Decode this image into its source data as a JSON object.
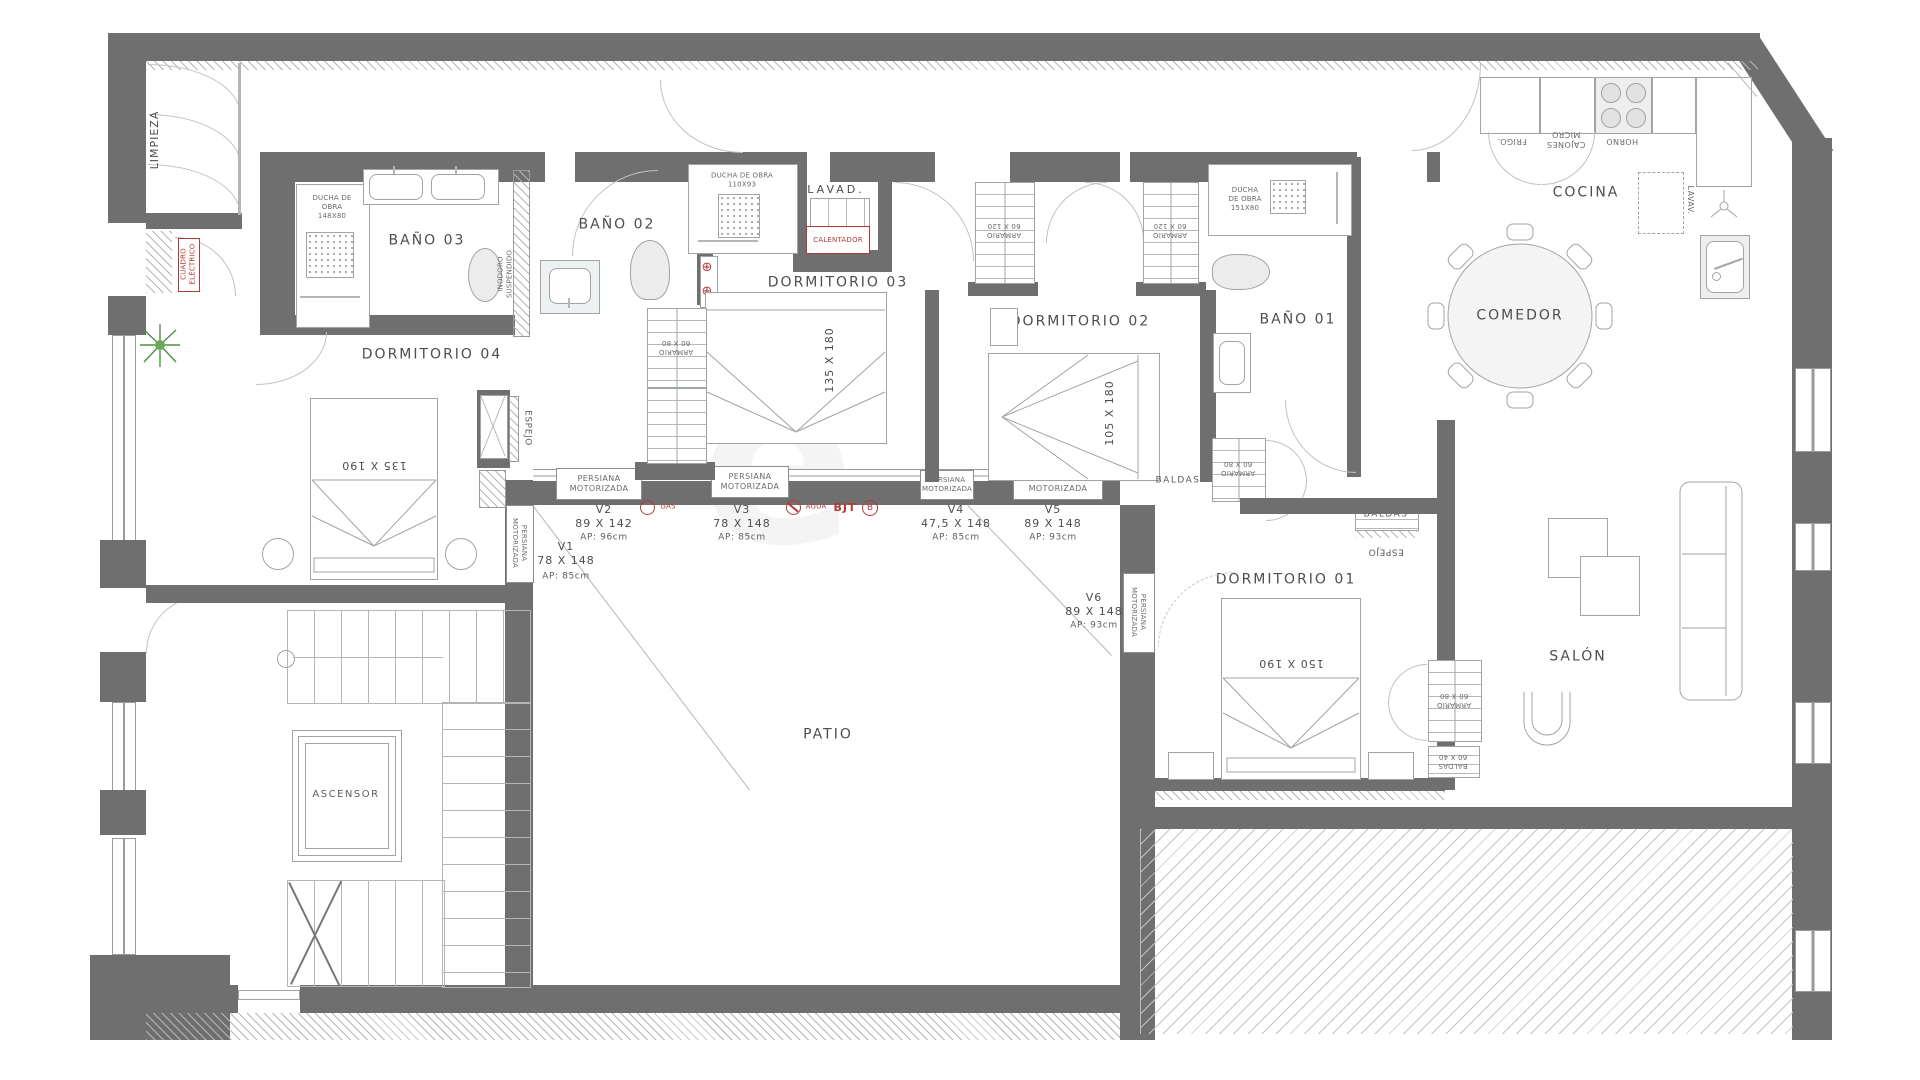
{
  "rooms": {
    "limpieza": "LIMPIEZA",
    "bano03": "BAÑO 03",
    "bano02": "BAÑO 02",
    "bano01": "BAÑO 01",
    "dormitorio01": "DORMITORIO 01",
    "dormitorio02": "DORMITORIO 02",
    "dormitorio03": "DORMITORIO 03",
    "dormitorio04": "DORMITORIO 04",
    "lavadero": "LAVAD.",
    "cocina": "COCINA",
    "comedor": "COMEDOR",
    "salon": "SALÓN",
    "patio": "PATIO",
    "ascensor": "ASCENSOR"
  },
  "fixtures": {
    "ducha_bano03": "DUCHA DE\nOBRA\n148X80",
    "ducha_bano02": "DUCHA DE OBRA\n110X93",
    "ducha_bano01": "DUCHA\nDE OBRA\n151X80",
    "inodoro_suspendido": "INODORO\nSUSPENDIDO",
    "calentador": "CALENTADOR",
    "cuadro_electrico": "CUADRO\nELÉCTRICO",
    "frigo": "FRIGO.",
    "cajones_micro": "CAJONES\nMICRO",
    "horno": "HORNO",
    "lavavajillas": "LAVAV.",
    "armario_60x80": "ARMARIO\n60 X 80",
    "armario_60x120": "ARMARIO\n60 X 120",
    "baldas": "BALDAS",
    "baldas_60x40": "BALDAS\n60 X 40",
    "espejo": "ESPEJO",
    "persiana": "PERSIANA\nMOTORIZADA",
    "bed_135x180": "135 X 180",
    "bed_105x180": "105 X 180",
    "bed_135x190": "135 X 190",
    "bed_150x190": "150 X 190"
  },
  "windows": {
    "v1": {
      "name": "V1",
      "size": "78 X 148",
      "ap": "AP: 85cm"
    },
    "v2": {
      "name": "V2",
      "size": "89 X 142",
      "ap": "AP: 96cm"
    },
    "v3": {
      "name": "V3",
      "size": "78 X 148",
      "ap": "AP: 85cm"
    },
    "v4": {
      "name": "V4",
      "size": "47,5 X 148",
      "ap": "AP: 85cm"
    },
    "v5": {
      "name": "V5",
      "size": "89 X 148",
      "ap": "AP: 93cm"
    },
    "v6": {
      "name": "V6",
      "size": "89 X 148",
      "ap": "AP: 93cm"
    }
  },
  "symbols": {
    "gas": "GAS",
    "agua": "AGUA",
    "bjt": "BJT",
    "bjt_circle": "B",
    "outlet": "⊕"
  },
  "colors": {
    "wall": "#6f6f70",
    "furniture_line": "#9fa4a7",
    "label": "#4d4d4d",
    "accent_red": "#b23b36",
    "plant_green": "#4e8f45"
  }
}
